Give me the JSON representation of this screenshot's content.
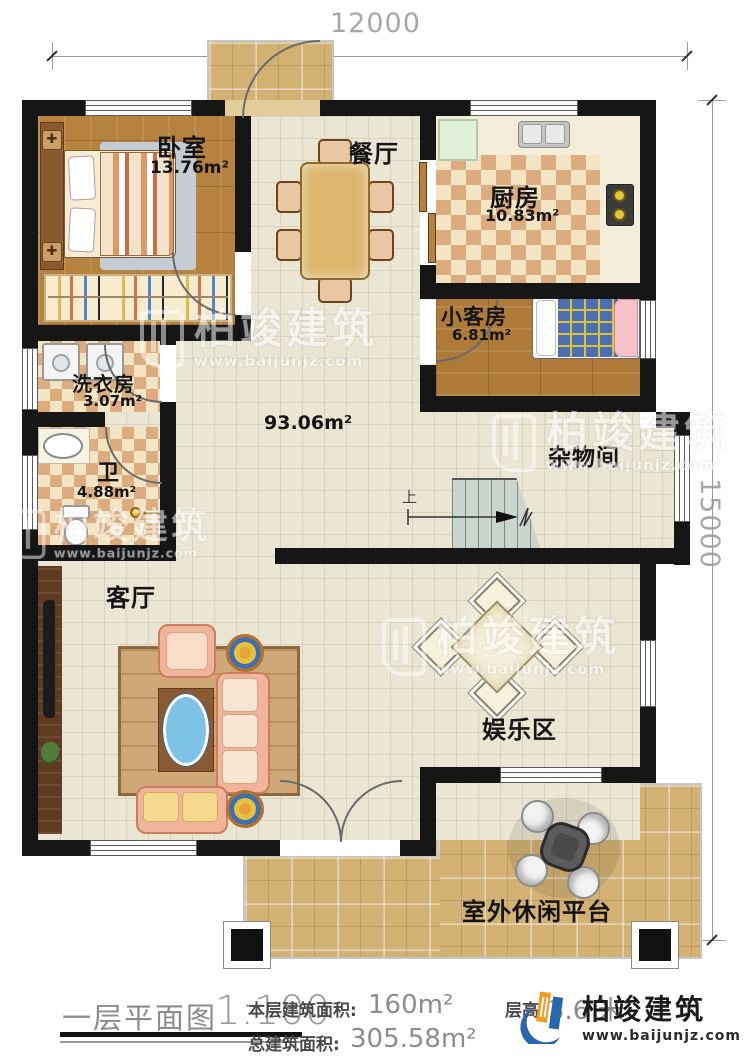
{
  "dimensions": {
    "top": "12000",
    "right": "15000"
  },
  "rooms": {
    "bedroom": {
      "name": "卧室",
      "area": "13.76m²"
    },
    "dining": {
      "name": "餐厅"
    },
    "kitchen": {
      "name": "厨房",
      "area": "10.83m²"
    },
    "guest_room": {
      "name": "小客房",
      "area": "6.81m²"
    },
    "laundry": {
      "name": "洗衣房",
      "area": "3.07m²"
    },
    "bathroom": {
      "name": "卫",
      "area": "4.88m²"
    },
    "hall": {
      "area": "93.06m²"
    },
    "storage": {
      "name": "杂物间"
    },
    "living": {
      "name": "客厅"
    },
    "entertainment": {
      "name": "娱乐区"
    },
    "terrace": {
      "name": "室外休闲平台"
    }
  },
  "stairs": {
    "up": "上"
  },
  "title_block": {
    "plan_name": "一层平面图",
    "scale": "1:100",
    "floor_area_label": "本层建筑面积:",
    "floor_area_value": "160m²",
    "height_label": "层高:",
    "height_value": "3.6 米",
    "total_area_label": "总建筑面积:",
    "total_area_value": "305.58m²"
  },
  "brand": {
    "name": "柏竣建筑",
    "url": "www.baijunjz.com"
  },
  "watermark": {
    "name": "柏竣建筑",
    "url": "www.baijunjz.com"
  },
  "colors": {
    "wall": "#161616",
    "tile": "#eae6d3",
    "wood": "#b5823f",
    "accent_blue": "#2866ae",
    "accent_orange": "#f29b1d"
  }
}
